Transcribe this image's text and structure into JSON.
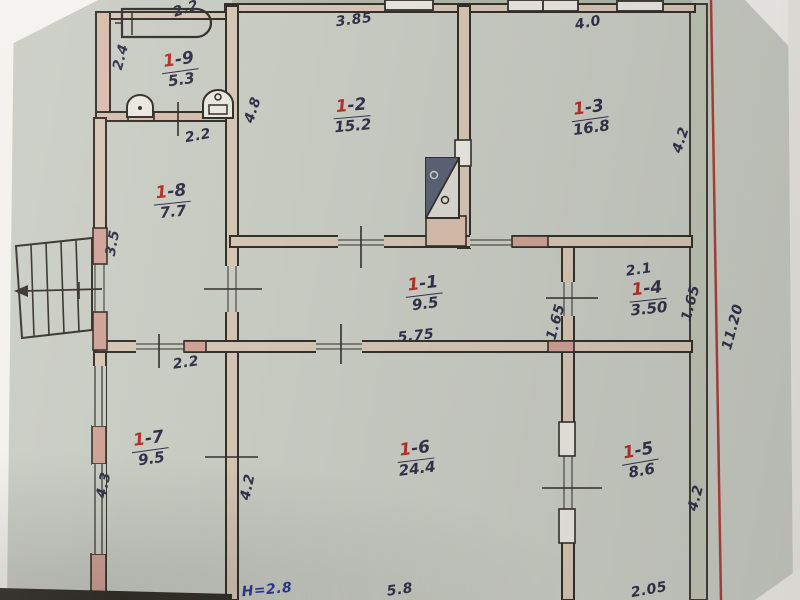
{
  "rooms": [
    {
      "id": "1-9",
      "prefix": "1",
      "suffix": "-9",
      "area": "5.3"
    },
    {
      "id": "1-8",
      "prefix": "1",
      "suffix": "-8",
      "area": "7.7"
    },
    {
      "id": "1-2",
      "prefix": "1",
      "suffix": "-2",
      "area": "15.2"
    },
    {
      "id": "1-3",
      "prefix": "1",
      "suffix": "-3",
      "area": "16.8"
    },
    {
      "id": "1-1",
      "prefix": "1",
      "suffix": "-1",
      "area": "9.5"
    },
    {
      "id": "1-4",
      "prefix": "1",
      "suffix": "-4",
      "area": "3.50"
    },
    {
      "id": "1-7",
      "prefix": "1",
      "suffix": "-7",
      "area": "9.5"
    },
    {
      "id": "1-6",
      "prefix": "1",
      "suffix": "-6",
      "area": "24.4"
    },
    {
      "id": "1-5",
      "prefix": "1",
      "suffix": "-5",
      "area": "8.6"
    }
  ],
  "dims": {
    "bath_top": "2.2",
    "bath_left": "2.4",
    "bath_door": "2.2",
    "r2_top": "3.85",
    "r2_left": "4.8",
    "r3_top": "4.0",
    "r3_right": "4.2",
    "r8_left": "3.5",
    "r8_door": "2.2",
    "corridor_len": "5.75",
    "r4_top": "2.1",
    "r4_left": "1.65",
    "r4_right": "1.65",
    "right_total": "11.20",
    "r7_left": "4.3",
    "r6_left": "4.2",
    "r6_bottom": "5.8",
    "r5_right": "4.2",
    "r5_bottom": "2.05",
    "height_note": "H=2.8"
  },
  "icons": {
    "bathtub": "bathtub-icon",
    "toilet": "toilet-icon",
    "washbasin": "washbasin-icon",
    "stove": "stove-icon",
    "staircase": "staircase-symbol",
    "red_line": "red-reference-line"
  },
  "colors": {
    "paper": "#c9ccc3",
    "ink": "#33324a",
    "room_number_red": "#b23229",
    "height_blue": "#2e3a96",
    "red_line": "#a8332d",
    "wall_fill": "#d5c5b4",
    "pier_pink": "#d0a196"
  }
}
